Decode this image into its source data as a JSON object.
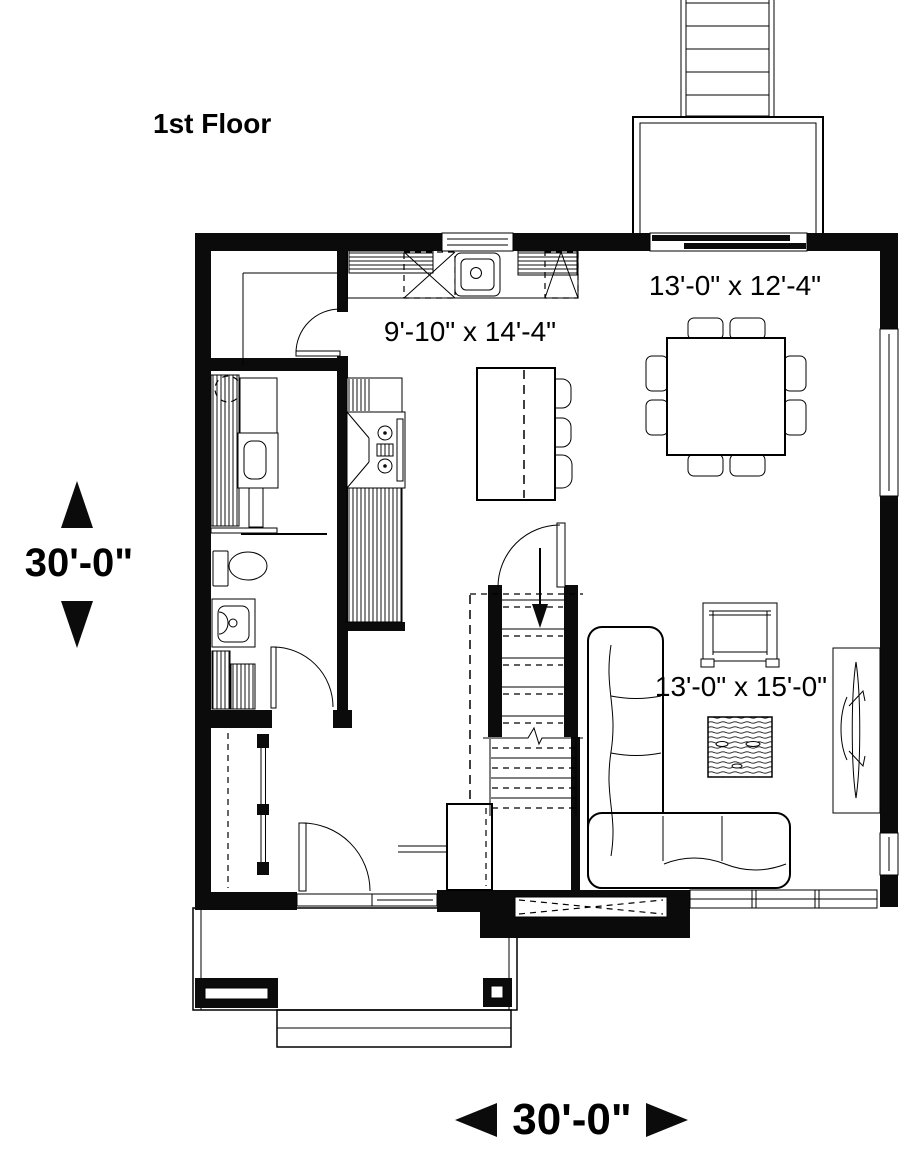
{
  "title": "1st Floor",
  "dimensions": {
    "overall_depth": "30'-0\"",
    "overall_width": "30'-0\""
  },
  "rooms": {
    "kitchen": {
      "size": "9'-10\" x 14'-4\""
    },
    "dining": {
      "size": "13'-0\" x 12'-4\""
    },
    "living": {
      "size": "13'-0\" x 15'-0\""
    }
  },
  "colors": {
    "ink": "#000000",
    "paper": "#ffffff"
  },
  "fixtures": [
    "kitchen-sink",
    "range-with-hood",
    "kitchen-island",
    "bar-stools",
    "corner-cabinets",
    "dining-table",
    "dining-chairs",
    "sectional-sofa",
    "armchair",
    "coffee-table",
    "console-table",
    "toilet",
    "vanity-sink",
    "washer",
    "linen-shelves",
    "entry-closet",
    "stairs-down",
    "front-door",
    "patio-sliding-door",
    "rear-deck",
    "deck-stairs",
    "front-porch",
    "porch-steps",
    "planter",
    "porch-post",
    "bay-window"
  ]
}
